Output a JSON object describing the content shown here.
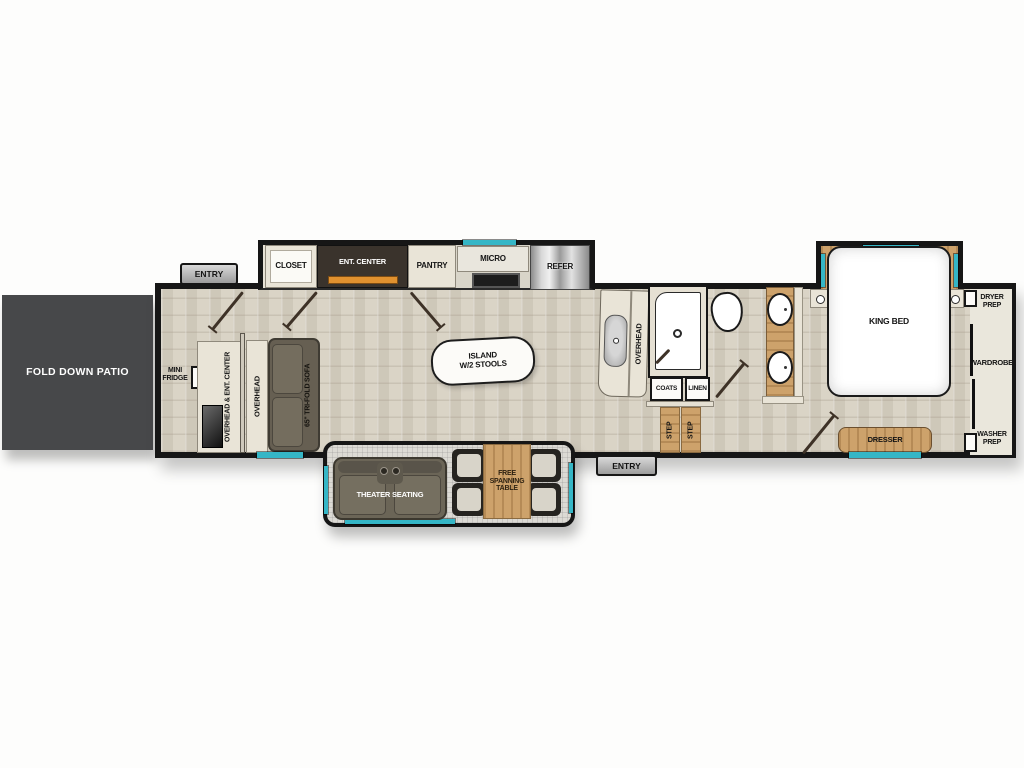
{
  "patio": {
    "label": "FOLD DOWN PATIO"
  },
  "garage": {
    "entry": "ENTRY",
    "mini_fridge": "MINI\nFRIDGE",
    "overhead_ent_center": "OVERHEAD & ENT. CENTER",
    "overhead": "OVERHEAD",
    "sofa": "65\" TRI-FOLD SOFA"
  },
  "kitchen": {
    "closet": "CLOSET",
    "ent_center": "ENT. CENTER",
    "pantry": "PANTRY",
    "micro": "MICRO",
    "refer": "REFER",
    "island": "ISLAND\nW/2 STOOLS",
    "counter_overhead": "OVERHEAD"
  },
  "dinette_slide": {
    "theater": "THEATER SEATING",
    "table": "FREE\nSPANNING\nTABLE"
  },
  "bath": {
    "coats": "COATS",
    "linen": "LINEN",
    "steps": [
      "STEP",
      "STEP"
    ],
    "entry": "ENTRY"
  },
  "bedroom": {
    "king_bed": "KING BED",
    "dresser": "DRESSER",
    "dryer_prep": "DRYER\nPREP",
    "wardrobe": "WARDROBE",
    "washer_prep": "WASHER\nPREP"
  },
  "colors": {
    "wall": "#161616",
    "floor": "#d7d1c3",
    "patio": "#47484a",
    "teal_window": "#35b6c6",
    "wood": "#cda26b",
    "accent_orange": "#e0912f",
    "sofa_gray": "#6b6557"
  }
}
